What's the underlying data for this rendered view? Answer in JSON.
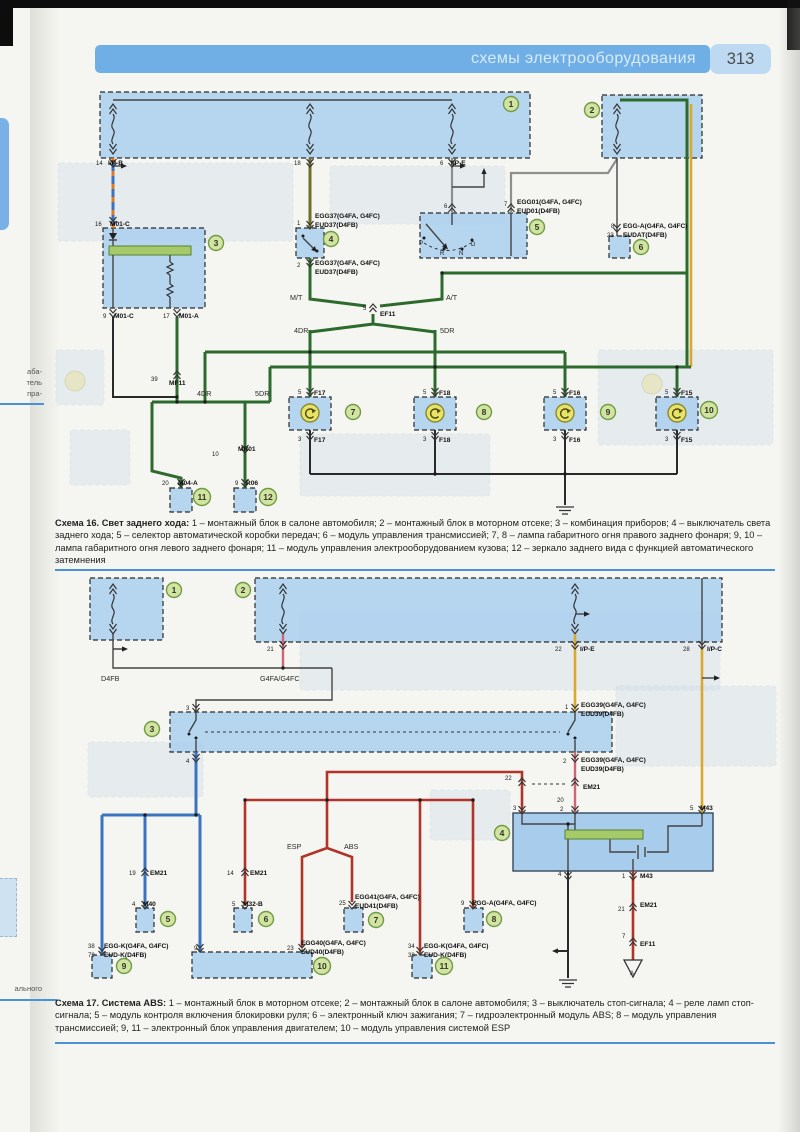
{
  "header": {
    "title": "схемы электрооборудования",
    "page_number": "313"
  },
  "margin": {
    "side_fragments": [
      "аба-",
      "тель",
      "пра-"
    ],
    "bottom_fragment": "ального"
  },
  "icons": {
    "fuse": "wavy-line",
    "connector": "double-chevron",
    "ground": "ground-bars",
    "lamp": "circle-arrow",
    "splice": "triangle-A"
  },
  "colors": {
    "header_bg": "#6fafe6",
    "page_num_bg": "#bedaf3",
    "rule": "#4a92d4",
    "box_fill": "#aacfee",
    "callout_fill": "#d3e3a3",
    "wire_green": "#2d6a2d",
    "wire_red": "#b03428",
    "wire_blue": "#3a74c0",
    "wire_yellow": "#d8a92c",
    "wire_pink": "#cc6677",
    "wire_orange": "#e07820",
    "wire_olive": "#6f6f28"
  },
  "diagram16": {
    "caption_lead": "Схема 16. Свет заднего хода:",
    "caption_body": " 1 – монтажный блок в салоне автомобиля; 2 – монтажный блок в моторном отсеке; 3 – комбинация приборов; 4 – выключатель света заднего хода; 5 – селектор автоматической коробки передач; 6 – модуль управления трансмиссией; 7, 8 – лампа габаритного огня правого заднего фонаря; 9, 10 – лампа габаритного огня левого заднего фонаря; 11 – модуль управления электрооборудованием кузова; 12 – зеркало заднего вида с функцией автоматического затемнения",
    "callouts": [
      {
        "n": "1",
        "x": 511,
        "y": 104
      },
      {
        "n": "2",
        "x": 592,
        "y": 110
      },
      {
        "n": "3",
        "x": 216,
        "y": 243
      },
      {
        "n": "4",
        "x": 331,
        "y": 239
      },
      {
        "n": "5",
        "x": 537,
        "y": 227
      },
      {
        "n": "6",
        "x": 641,
        "y": 247
      },
      {
        "n": "7",
        "x": 353,
        "y": 412
      },
      {
        "n": "8",
        "x": 484,
        "y": 412
      },
      {
        "n": "9",
        "x": 608,
        "y": 412
      },
      {
        "n": "10",
        "x": 709,
        "y": 410
      },
      {
        "n": "11",
        "x": 202,
        "y": 497
      },
      {
        "n": "12",
        "x": 268,
        "y": 497
      }
    ],
    "labels": [
      {
        "t": "14",
        "x": 96,
        "y": 165,
        "c": "n"
      },
      {
        "t": "I/P-B",
        "x": 108,
        "y": 165,
        "c": "b"
      },
      {
        "t": "18",
        "x": 294,
        "y": 165,
        "c": "n"
      },
      {
        "t": "6",
        "x": 440,
        "y": 165,
        "c": "n"
      },
      {
        "t": "I/P-E",
        "x": 451,
        "y": 165,
        "c": "b"
      },
      {
        "t": "16",
        "x": 95,
        "y": 226,
        "c": "n"
      },
      {
        "t": "M01-C",
        "x": 110,
        "y": 226,
        "c": "b"
      },
      {
        "t": "1",
        "x": 297,
        "y": 225,
        "c": "n"
      },
      {
        "t": "EGG37(G4FA, G4FC)",
        "x": 315,
        "y": 218,
        "c": "b"
      },
      {
        "t": "EUD37(D4FB)",
        "x": 315,
        "y": 227,
        "c": "b"
      },
      {
        "t": "2",
        "x": 297,
        "y": 267,
        "c": "n"
      },
      {
        "t": "EGG37(G4FA, G4FC)",
        "x": 315,
        "y": 265,
        "c": "b"
      },
      {
        "t": "EUD37(D4FB)",
        "x": 315,
        "y": 274,
        "c": "b"
      },
      {
        "t": "9",
        "x": 103,
        "y": 318,
        "c": "n"
      },
      {
        "t": "M01-C",
        "x": 114,
        "y": 318,
        "c": "b"
      },
      {
        "t": "17",
        "x": 163,
        "y": 318,
        "c": "n"
      },
      {
        "t": "M01-A",
        "x": 179,
        "y": 318,
        "c": "b"
      },
      {
        "t": "M/T",
        "x": 290,
        "y": 300,
        "c": "p"
      },
      {
        "t": "A/T",
        "x": 446,
        "y": 300,
        "c": "p"
      },
      {
        "t": "5",
        "x": 363,
        "y": 310,
        "c": "n"
      },
      {
        "t": "EF11",
        "x": 380,
        "y": 316,
        "c": "b"
      },
      {
        "t": "4DR",
        "x": 294,
        "y": 333,
        "c": "p"
      },
      {
        "t": "5DR",
        "x": 440,
        "y": 333,
        "c": "p"
      },
      {
        "t": "39",
        "x": 151,
        "y": 381,
        "c": "n"
      },
      {
        "t": "MF11",
        "x": 169,
        "y": 385,
        "c": "b"
      },
      {
        "t": "4DR",
        "x": 197,
        "y": 396,
        "c": "p"
      },
      {
        "t": "5DR",
        "x": 255,
        "y": 396,
        "c": "p"
      },
      {
        "t": "5",
        "x": 298,
        "y": 394,
        "c": "n"
      },
      {
        "t": "F17",
        "x": 314,
        "y": 395,
        "c": "b"
      },
      {
        "t": "3",
        "x": 298,
        "y": 441,
        "c": "n"
      },
      {
        "t": "F17",
        "x": 314,
        "y": 442,
        "c": "b"
      },
      {
        "t": "5",
        "x": 423,
        "y": 394,
        "c": "n"
      },
      {
        "t": "F18",
        "x": 439,
        "y": 395,
        "c": "b"
      },
      {
        "t": "3",
        "x": 423,
        "y": 441,
        "c": "n"
      },
      {
        "t": "F18",
        "x": 439,
        "y": 442,
        "c": "b"
      },
      {
        "t": "5",
        "x": 553,
        "y": 394,
        "c": "n"
      },
      {
        "t": "F16",
        "x": 569,
        "y": 395,
        "c": "b"
      },
      {
        "t": "3",
        "x": 553,
        "y": 441,
        "c": "n"
      },
      {
        "t": "F16",
        "x": 569,
        "y": 442,
        "c": "b"
      },
      {
        "t": "5",
        "x": 665,
        "y": 394,
        "c": "n"
      },
      {
        "t": "F15",
        "x": 681,
        "y": 395,
        "c": "b"
      },
      {
        "t": "3",
        "x": 665,
        "y": 441,
        "c": "n"
      },
      {
        "t": "F15",
        "x": 681,
        "y": 442,
        "c": "b"
      },
      {
        "t": "10",
        "x": 212,
        "y": 456,
        "c": "n"
      },
      {
        "t": "MR01",
        "x": 238,
        "y": 451,
        "c": "b"
      },
      {
        "t": "20",
        "x": 162,
        "y": 485,
        "c": "n"
      },
      {
        "t": "M04-A",
        "x": 178,
        "y": 485,
        "c": "b"
      },
      {
        "t": "9",
        "x": 235,
        "y": 485,
        "c": "n"
      },
      {
        "t": "R06",
        "x": 246,
        "y": 485,
        "c": "b"
      },
      {
        "t": "6",
        "x": 444,
        "y": 208,
        "c": "n"
      },
      {
        "t": "7",
        "x": 504,
        "y": 206,
        "c": "n"
      },
      {
        "t": "EGG01(G4FA, G4FC)",
        "x": 517,
        "y": 204,
        "c": "b"
      },
      {
        "t": "EUD01(D4FB)",
        "x": 517,
        "y": 213,
        "c": "b"
      },
      {
        "t": "8",
        "x": 611,
        "y": 228,
        "c": "n"
      },
      {
        "t": "EGG-A(G4FA, G4FC)",
        "x": 623,
        "y": 228,
        "c": "b"
      },
      {
        "t": "23",
        "x": 607,
        "y": 237,
        "c": "n"
      },
      {
        "t": "EUDAT(D4FB)",
        "x": 623,
        "y": 237,
        "c": "b"
      },
      {
        "t": "P",
        "x": 419,
        "y": 245,
        "c": "n"
      },
      {
        "t": "R",
        "x": 440,
        "y": 255,
        "c": "n"
      },
      {
        "t": "N",
        "x": 459,
        "y": 255,
        "c": "n"
      },
      {
        "t": "D",
        "x": 471,
        "y": 246,
        "c": "n"
      }
    ]
  },
  "diagram17": {
    "caption_lead": "Схема 17. Система ABS:",
    "caption_body": " 1 – монтажный блок в моторном отсеке; 2 – монтажный блок в салоне автомобиля; 3 – выключатель стоп-сигнала; 4 – реле ламп стоп-сигнала; 5 – модуль контроля включения блокировки руля; 6 – электронный ключ зажигания; 7 – гидроэлектронный модуль ABS; 8 – модуль управления трансмиссией; 9, 11 – электронный блок управления двигателем; 10 – модуль управления системой ESP",
    "callouts": [
      {
        "n": "1",
        "x": 174,
        "y": 590
      },
      {
        "n": "2",
        "x": 243,
        "y": 590
      },
      {
        "n": "3",
        "x": 152,
        "y": 729
      },
      {
        "n": "4",
        "x": 502,
        "y": 833
      },
      {
        "n": "5",
        "x": 168,
        "y": 919
      },
      {
        "n": "6",
        "x": 266,
        "y": 919
      },
      {
        "n": "7",
        "x": 376,
        "y": 920
      },
      {
        "n": "8",
        "x": 494,
        "y": 919
      },
      {
        "n": "9",
        "x": 124,
        "y": 966
      },
      {
        "n": "10",
        "x": 322,
        "y": 966
      },
      {
        "n": "11",
        "x": 444,
        "y": 966
      }
    ],
    "labels": [
      {
        "t": "D4FB",
        "x": 101,
        "y": 681,
        "c": "p"
      },
      {
        "t": "21",
        "x": 267,
        "y": 651,
        "c": "n"
      },
      {
        "t": "G4FA/G4FC",
        "x": 260,
        "y": 681,
        "c": "p"
      },
      {
        "t": "22",
        "x": 555,
        "y": 651,
        "c": "n"
      },
      {
        "t": "I/P-E",
        "x": 580,
        "y": 651,
        "c": "b"
      },
      {
        "t": "28",
        "x": 683,
        "y": 651,
        "c": "n"
      },
      {
        "t": "I/P-C",
        "x": 707,
        "y": 651,
        "c": "b"
      },
      {
        "t": "3",
        "x": 186,
        "y": 710,
        "c": "n"
      },
      {
        "t": "4",
        "x": 186,
        "y": 763,
        "c": "n"
      },
      {
        "t": "1",
        "x": 565,
        "y": 709,
        "c": "n"
      },
      {
        "t": "EGG39(G4FA, G4FC)",
        "x": 581,
        "y": 707,
        "c": "b"
      },
      {
        "t": "EUD39(D4FB)",
        "x": 581,
        "y": 716,
        "c": "b"
      },
      {
        "t": "2",
        "x": 563,
        "y": 763,
        "c": "n"
      },
      {
        "t": "EGG39(G4FA, G4FC)",
        "x": 581,
        "y": 762,
        "c": "b"
      },
      {
        "t": "EUD39(D4FB)",
        "x": 581,
        "y": 771,
        "c": "b"
      },
      {
        "t": "22",
        "x": 505,
        "y": 780,
        "c": "n"
      },
      {
        "t": "EM21",
        "x": 583,
        "y": 789,
        "c": "b"
      },
      {
        "t": "20",
        "x": 557,
        "y": 802,
        "c": "n"
      },
      {
        "t": "3",
        "x": 513,
        "y": 810,
        "c": "n"
      },
      {
        "t": "2",
        "x": 560,
        "y": 811,
        "c": "n"
      },
      {
        "t": "5",
        "x": 690,
        "y": 810,
        "c": "n"
      },
      {
        "t": "M43",
        "x": 700,
        "y": 810,
        "c": "b"
      },
      {
        "t": "4",
        "x": 558,
        "y": 876,
        "c": "n"
      },
      {
        "t": "1",
        "x": 622,
        "y": 878,
        "c": "n"
      },
      {
        "t": "M43",
        "x": 640,
        "y": 878,
        "c": "b"
      },
      {
        "t": "21",
        "x": 618,
        "y": 911,
        "c": "n"
      },
      {
        "t": "EM21",
        "x": 640,
        "y": 907,
        "c": "b"
      },
      {
        "t": "7",
        "x": 622,
        "y": 938,
        "c": "n"
      },
      {
        "t": "EF11",
        "x": 640,
        "y": 946,
        "c": "b"
      },
      {
        "t": "ESP",
        "x": 287,
        "y": 849,
        "c": "p"
      },
      {
        "t": "ABS",
        "x": 344,
        "y": 849,
        "c": "p"
      },
      {
        "t": "19",
        "x": 129,
        "y": 875,
        "c": "n"
      },
      {
        "t": "EM21",
        "x": 150,
        "y": 875,
        "c": "b"
      },
      {
        "t": "4",
        "x": 132,
        "y": 906,
        "c": "n"
      },
      {
        "t": "M40",
        "x": 143,
        "y": 906,
        "c": "b"
      },
      {
        "t": "14",
        "x": 227,
        "y": 875,
        "c": "n"
      },
      {
        "t": "EM21",
        "x": 250,
        "y": 875,
        "c": "b"
      },
      {
        "t": "5",
        "x": 232,
        "y": 906,
        "c": "n"
      },
      {
        "t": "M32-B",
        "x": 243,
        "y": 906,
        "c": "b"
      },
      {
        "t": "25",
        "x": 339,
        "y": 905,
        "c": "n"
      },
      {
        "t": "EGG41(G4FA, G4FC)",
        "x": 355,
        "y": 899,
        "c": "b"
      },
      {
        "t": "EUD41(D4FB)",
        "x": 355,
        "y": 908,
        "c": "b"
      },
      {
        "t": "9",
        "x": 461,
        "y": 905,
        "c": "n"
      },
      {
        "t": "EGG-A(G4FA, G4FC)",
        "x": 472,
        "y": 905,
        "c": "b"
      },
      {
        "t": "38",
        "x": 88,
        "y": 948,
        "c": "n"
      },
      {
        "t": "EGG-K(G4FA, G4FC)",
        "x": 104,
        "y": 948,
        "c": "b"
      },
      {
        "t": "79",
        "x": 88,
        "y": 957,
        "c": "n"
      },
      {
        "t": "EUD-K(D4FB)",
        "x": 104,
        "y": 957,
        "c": "b"
      },
      {
        "t": "9",
        "x": 194,
        "y": 950,
        "c": "n"
      },
      {
        "t": "23",
        "x": 287,
        "y": 950,
        "c": "n"
      },
      {
        "t": "EGG40(G4FA, G4FC)",
        "x": 301,
        "y": 945,
        "c": "b"
      },
      {
        "t": "EUD40(D4FB)",
        "x": 301,
        "y": 954,
        "c": "b"
      },
      {
        "t": "34",
        "x": 408,
        "y": 948,
        "c": "n"
      },
      {
        "t": "EGG-K(G4FA, G4FC)",
        "x": 424,
        "y": 948,
        "c": "b"
      },
      {
        "t": "38",
        "x": 408,
        "y": 957,
        "c": "n"
      },
      {
        "t": "EUD-K(D4FB)",
        "x": 424,
        "y": 957,
        "c": "b"
      },
      {
        "t": "A",
        "x": 630,
        "y": 975,
        "c": "n"
      }
    ]
  }
}
